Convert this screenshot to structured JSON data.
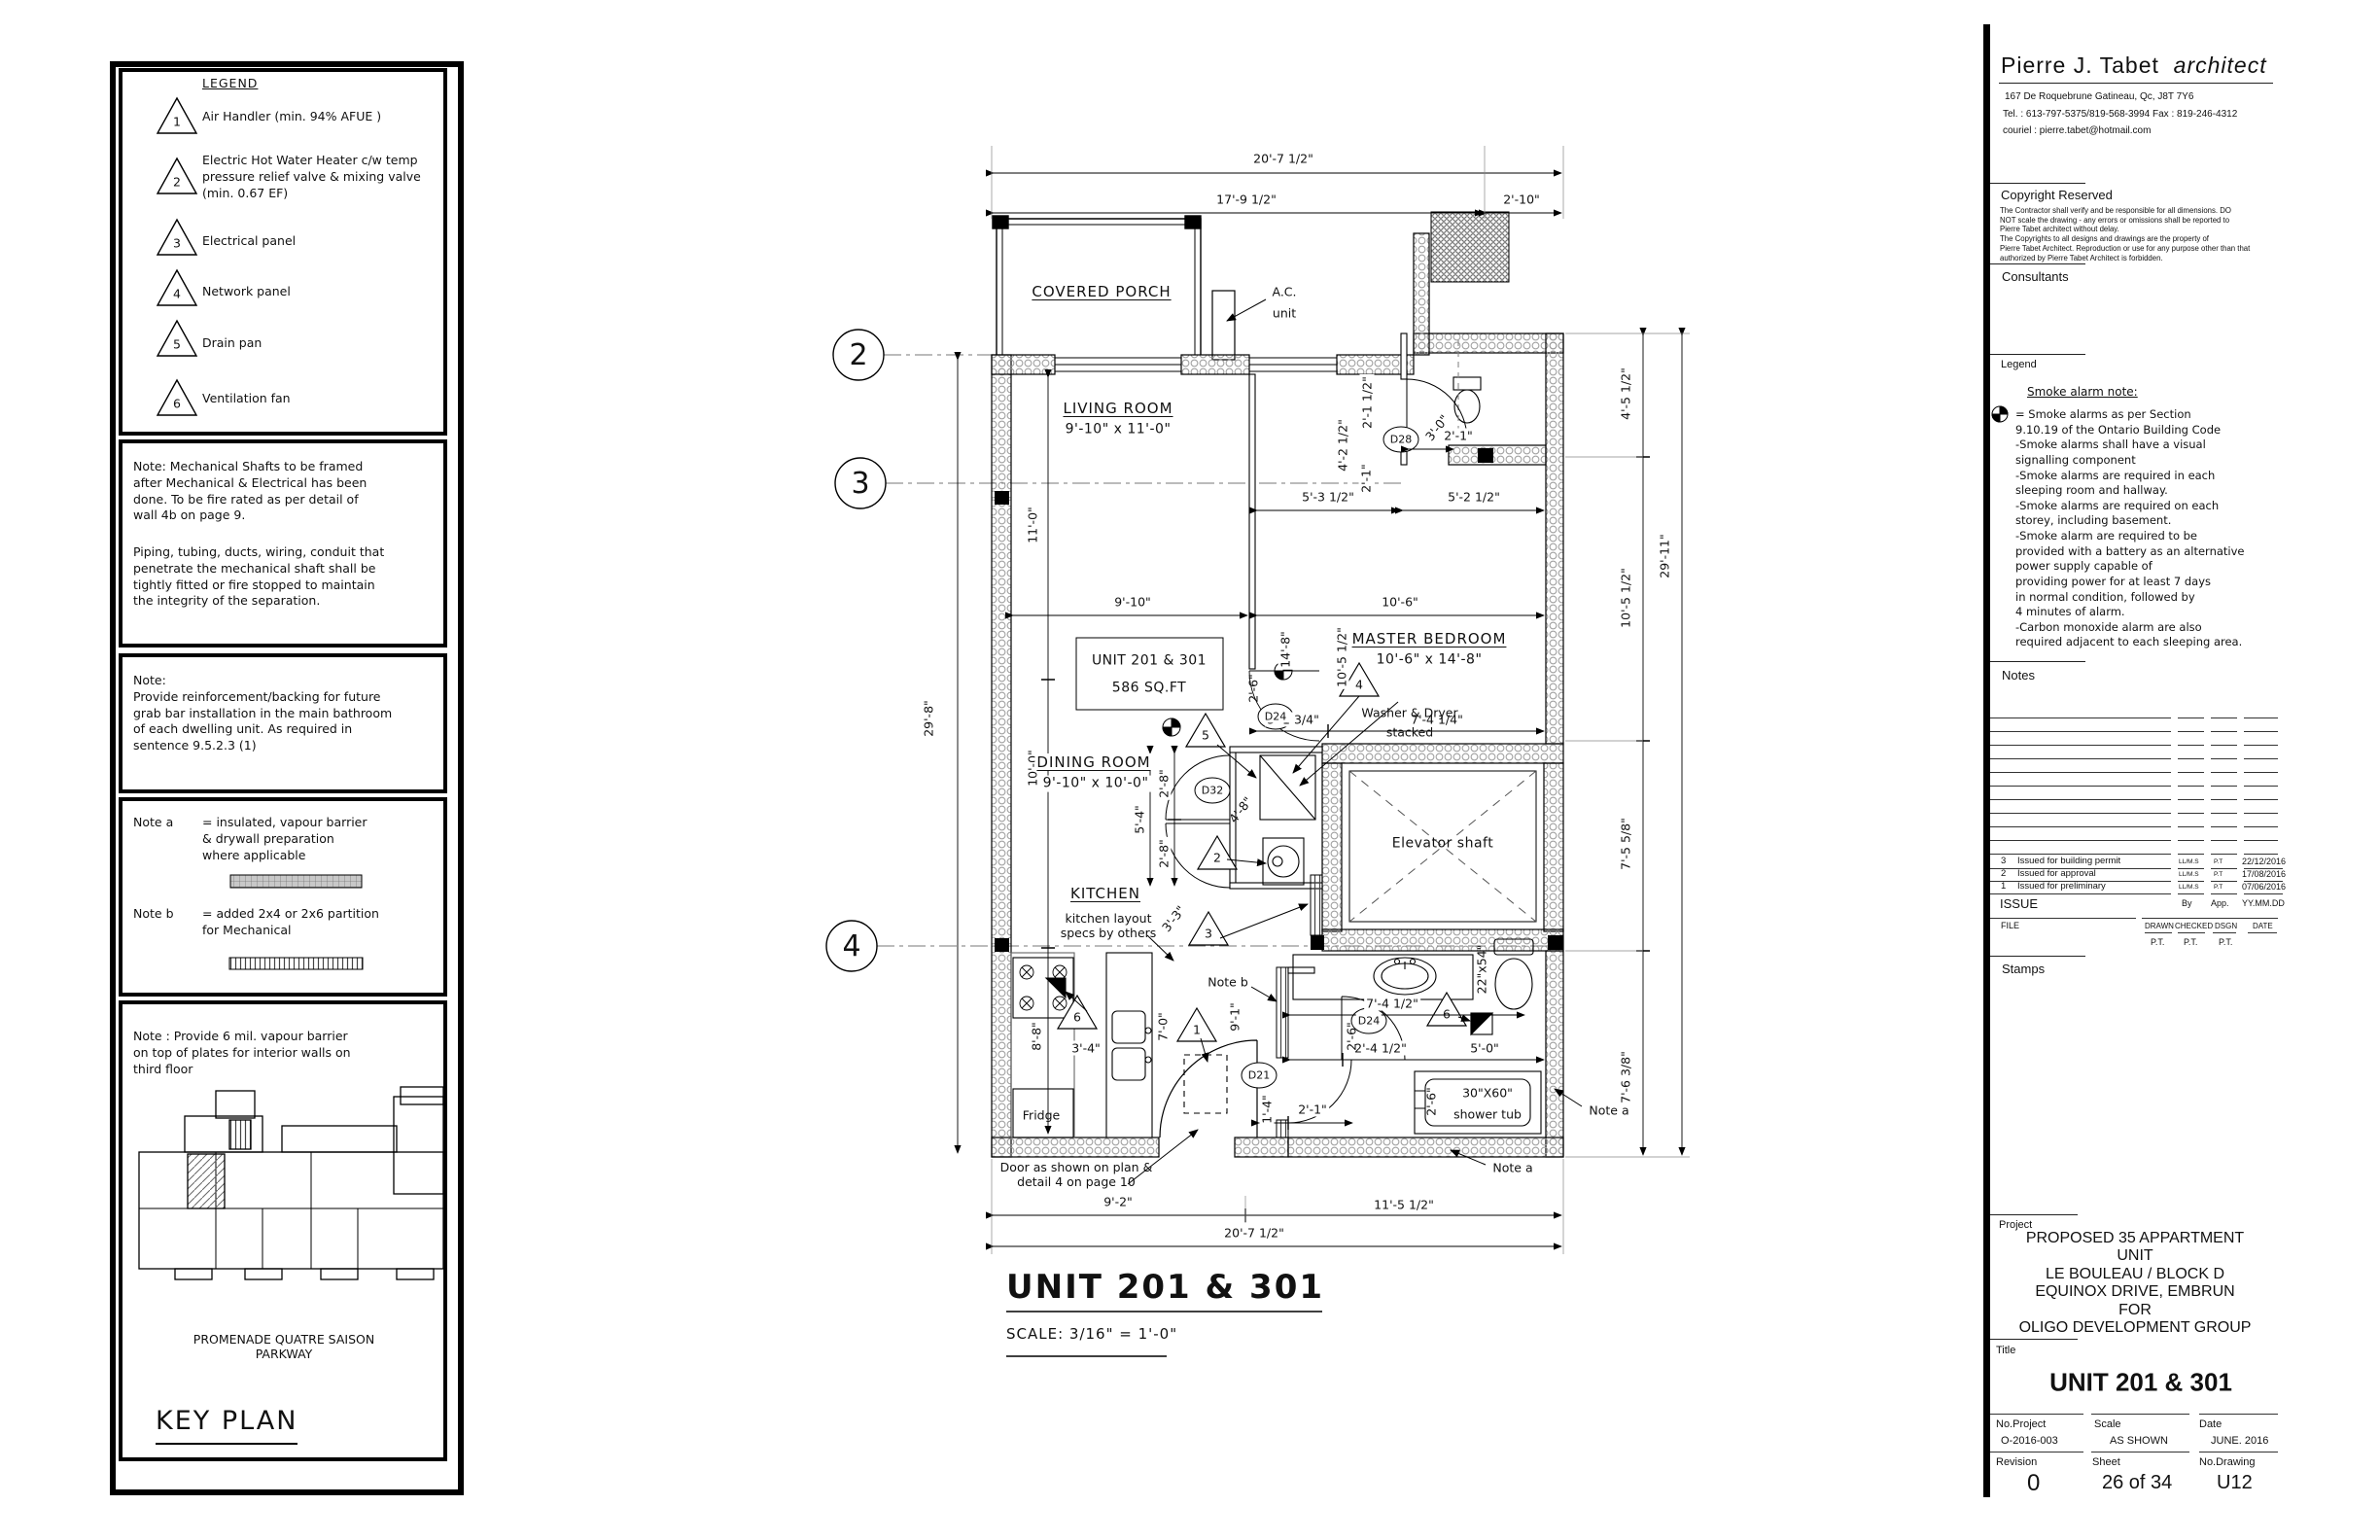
{
  "legend_panel": {
    "title": "LEGEND",
    "items": [
      {
        "num": "1",
        "label": "Air Handler (min. 94% AFUE )"
      },
      {
        "num": "2",
        "label": "Electric Hot Water Heater c/w temp\npressure relief valve & mixing valve\n(min. 0.67 EF)"
      },
      {
        "num": "3",
        "label": "Electrical panel"
      },
      {
        "num": "4",
        "label": "Network panel"
      },
      {
        "num": "5",
        "label": "Drain pan"
      },
      {
        "num": "6",
        "label": "Ventilation fan"
      }
    ]
  },
  "notes_panel": {
    "mech1": "Note: Mechanical Shafts to be framed\nafter Mechanical & Electrical has been\ndone. To be fire rated as per detail of\nwall 4b on page 9.",
    "mech2": "Piping, tubing, ducts, wiring, conduit that\npenetrate the mechanical shaft shall be\ntightly fitted or fire stopped to maintain\nthe integrity of the separation.",
    "grab": "Note:\nProvide reinforcement/backing for future\ngrab bar installation in the main bathroom\nof each dwelling unit. As required in\nsentence 9.5.2.3 (1)",
    "note_a_label": "Note a",
    "note_a_text": "= insulated, vapour barrier\n& drywall preparation\nwhere applicable",
    "note_b_label": "Note b",
    "note_b_text": "= added 2x4 or 2x6 partition\nfor Mechanical",
    "vapour": "Note : Provide 6 mil. vapour barrier\non top of plates for interior walls on\nthird floor"
  },
  "key_plan": {
    "street": "PROMENADE QUATRE SAISON\nPARKWAY",
    "title": "KEY PLAN"
  },
  "plan": {
    "grid": {
      "g2": "2",
      "g3": "3",
      "g4": "4"
    },
    "tri": {
      "t1": "1",
      "t2": "2",
      "t3": "3",
      "t4": "4",
      "t5": "5",
      "t6": "6"
    },
    "door_tags": {
      "d28": "D28",
      "d24a": "D24",
      "d32": "D32",
      "d24b": "D24",
      "d21": "D21"
    },
    "rooms": {
      "porch": "COVERED PORCH",
      "living": "LIVING ROOM",
      "living_dims": "9'-10\" x 11'-0\"",
      "master": "MASTER BEDROOM",
      "master_dims": "10'-6\" x 14'-8\"",
      "dining": "DINING ROOM",
      "dining_dims": "9'-10\" x 10'-0\"",
      "kitchen": "KITCHEN",
      "elevator": "Elevator shaft"
    },
    "labels": {
      "unit_label": "UNIT 201 & 301",
      "unit_area": "586 SQ.FT",
      "ac1": "A.C.",
      "ac2": "unit",
      "washer": "Washer & Dryer",
      "washer2": "stacked",
      "kitchen_note": "kitchen layout\nspecs by others",
      "fridge": "Fridge",
      "tub1": "30\"X60\"",
      "tub2": "shower tub",
      "note_a": "Note a",
      "note_b": "Note b",
      "door_note": "Door as shown on plan &\ndetail 4 on page 10"
    },
    "dims": {
      "top_overall": "20'-7 1/2\"",
      "top_17": "17'-9 1/2\"",
      "top_2_10": "2'-10\"",
      "w5_3": "5'-3 1/2\"",
      "w5_2": "5'-2 1/2\"",
      "w9_10": "9'-10\"",
      "w10_6": "10'-6\"",
      "w3_1": "3'-1 3/4\"",
      "w7_4q": "7'-4 1/4\"",
      "v11_0": "11'-0\"",
      "v10_0": "10'-0\"",
      "v29_8": "29'-8\"",
      "v14_8": "14'-8\"",
      "v10_5": "10'-5 1/2\"",
      "v5_4": "5'-4\"",
      "v2_8a": "2'-8\"",
      "v2_8b": "2'-8\"",
      "v4_8": "4'-8\"",
      "v2_6": "2'-6\"",
      "b4_2": "4'-2 1/2\"",
      "b2_1h": "2'-1 1/2\"",
      "b2_1a": "2'-1\"",
      "b2_1b": "2'-1\"",
      "b3_0": "3'-0\"",
      "k3_3": "3'-3\"",
      "k8_8": "8'-8\"",
      "k3_4": "3'-4\"",
      "k7_0": "7'-0\"",
      "k9_1": "9'-1\"",
      "bb7_4": "7'-4 1/2\"",
      "bb2_4": "2'-4 1/2\"",
      "bb5_0": "5'-0\"",
      "bb22x54": "22\"x54\"",
      "bb2_6a": "2'-6\"",
      "bb2_6b": "2'-6\"",
      "bb1_4": "1'-4\"",
      "bb2_1": "2'-1\"",
      "r4_5": "4'-5 1/2\"",
      "r10_5": "10'-5 1/2\"",
      "r7_5": "7'-5 5/8\"",
      "r7_6": "7'-6 3/8\"",
      "r29_11": "29'-11\"",
      "bot9_2": "9'-2\"",
      "bot11_5": "11'-5 1/2\"",
      "bot20_7": "20'-7 1/2\""
    },
    "title": "UNIT 201 & 301",
    "scale": "SCALE: 3/16\" = 1'-0\""
  },
  "titleblock": {
    "architect_name": "Pierre J. Tabet",
    "architect_word": "architect",
    "address": "167 De Roquebrune Gatineau, Qc, J8T 7Y6",
    "tel": "Tel. : 613-797-5375/819-568-3994 Fax : 819-246-4312",
    "email": "couriel : pierre.tabet@hotmail.com",
    "copyright_header": "Copyright Reserved",
    "copyright_text": "The Contractor shall verify and be responsible for all dimensions. DO\nNOT scale the drawing - any errors or omissions shall be reported to\nPierre Tabet architect without delay.\nThe Copyrights to all designs and drawings are the property of\nPierre Tabet Architect. Reproduction or use for any purpose other than that\nauthorized by Pierre Tabet Architect is forbidden.",
    "consultants": "Consultants",
    "legend_header": "Legend",
    "smoke_title": "Smoke alarm note:",
    "smoke_text": "= Smoke alarms as per Section\n9.10.19  of the Ontario Building Code\n-Smoke alarms shall have a visual\n  signalling component\n-Smoke alarms are required in each\n  sleeping room and hallway.\n-Smoke alarms are required on each\n  storey, including basement.\n-Smoke alarm are required to be\n  provided with a battery as an alternative\n  power supply capable of\n  providing power for  at least 7 days\n  in normal condition, followed by\n  4 minutes of alarm.\n-Carbon monoxide alarm are also\n  required adjacent to each sleeping area.",
    "notes_header": "Notes",
    "issue": {
      "rows": [
        {
          "no": "3",
          "desc": "Issued for building permit",
          "by": "LL/M.S",
          "app": "P.T",
          "date": "22/12/2016"
        },
        {
          "no": "2",
          "desc": "Issued for approval",
          "by": "LL/M.S",
          "app": "P.T",
          "date": "17/08/2016"
        },
        {
          "no": "1",
          "desc": "Issued for preliminary",
          "by": "LL/M.S",
          "app": "P.T",
          "date": "07/06/2016"
        }
      ],
      "label": "ISSUE",
      "by_h": "By",
      "app_h": "App.",
      "date_h": "YY.MM.DD"
    },
    "file_h": "FILE",
    "drawn_h": "DRAWN",
    "checked_h": "CHECKED",
    "dsgn_h": "DSGN",
    "date_h2": "DATE",
    "drawn_v": "P.T.",
    "checked_v": "P.T.",
    "dsgn_v": "P.T.",
    "stamps": "Stamps",
    "project_header": "Project",
    "project_lines": "PROPOSED 35 APPARTMENT UNIT\nLE BOULEAU / BLOCK D\nEQUINOX DRIVE, EMBRUN\nFOR\nOLIGO DEVELOPMENT GROUP",
    "title_header": "Title",
    "title_value": "UNIT 201 & 301",
    "no_project_h": "No.Project",
    "no_project": "O-2016-003",
    "scale_h": "Scale",
    "scale": "AS SHOWN",
    "date_h3": "Date",
    "date": "JUNE. 2016",
    "revision_h": "Revision",
    "revision": "0",
    "sheet_h": "Sheet",
    "sheet": "26  of 34",
    "drawing_h": "No.Drawing",
    "drawing": "U12"
  }
}
